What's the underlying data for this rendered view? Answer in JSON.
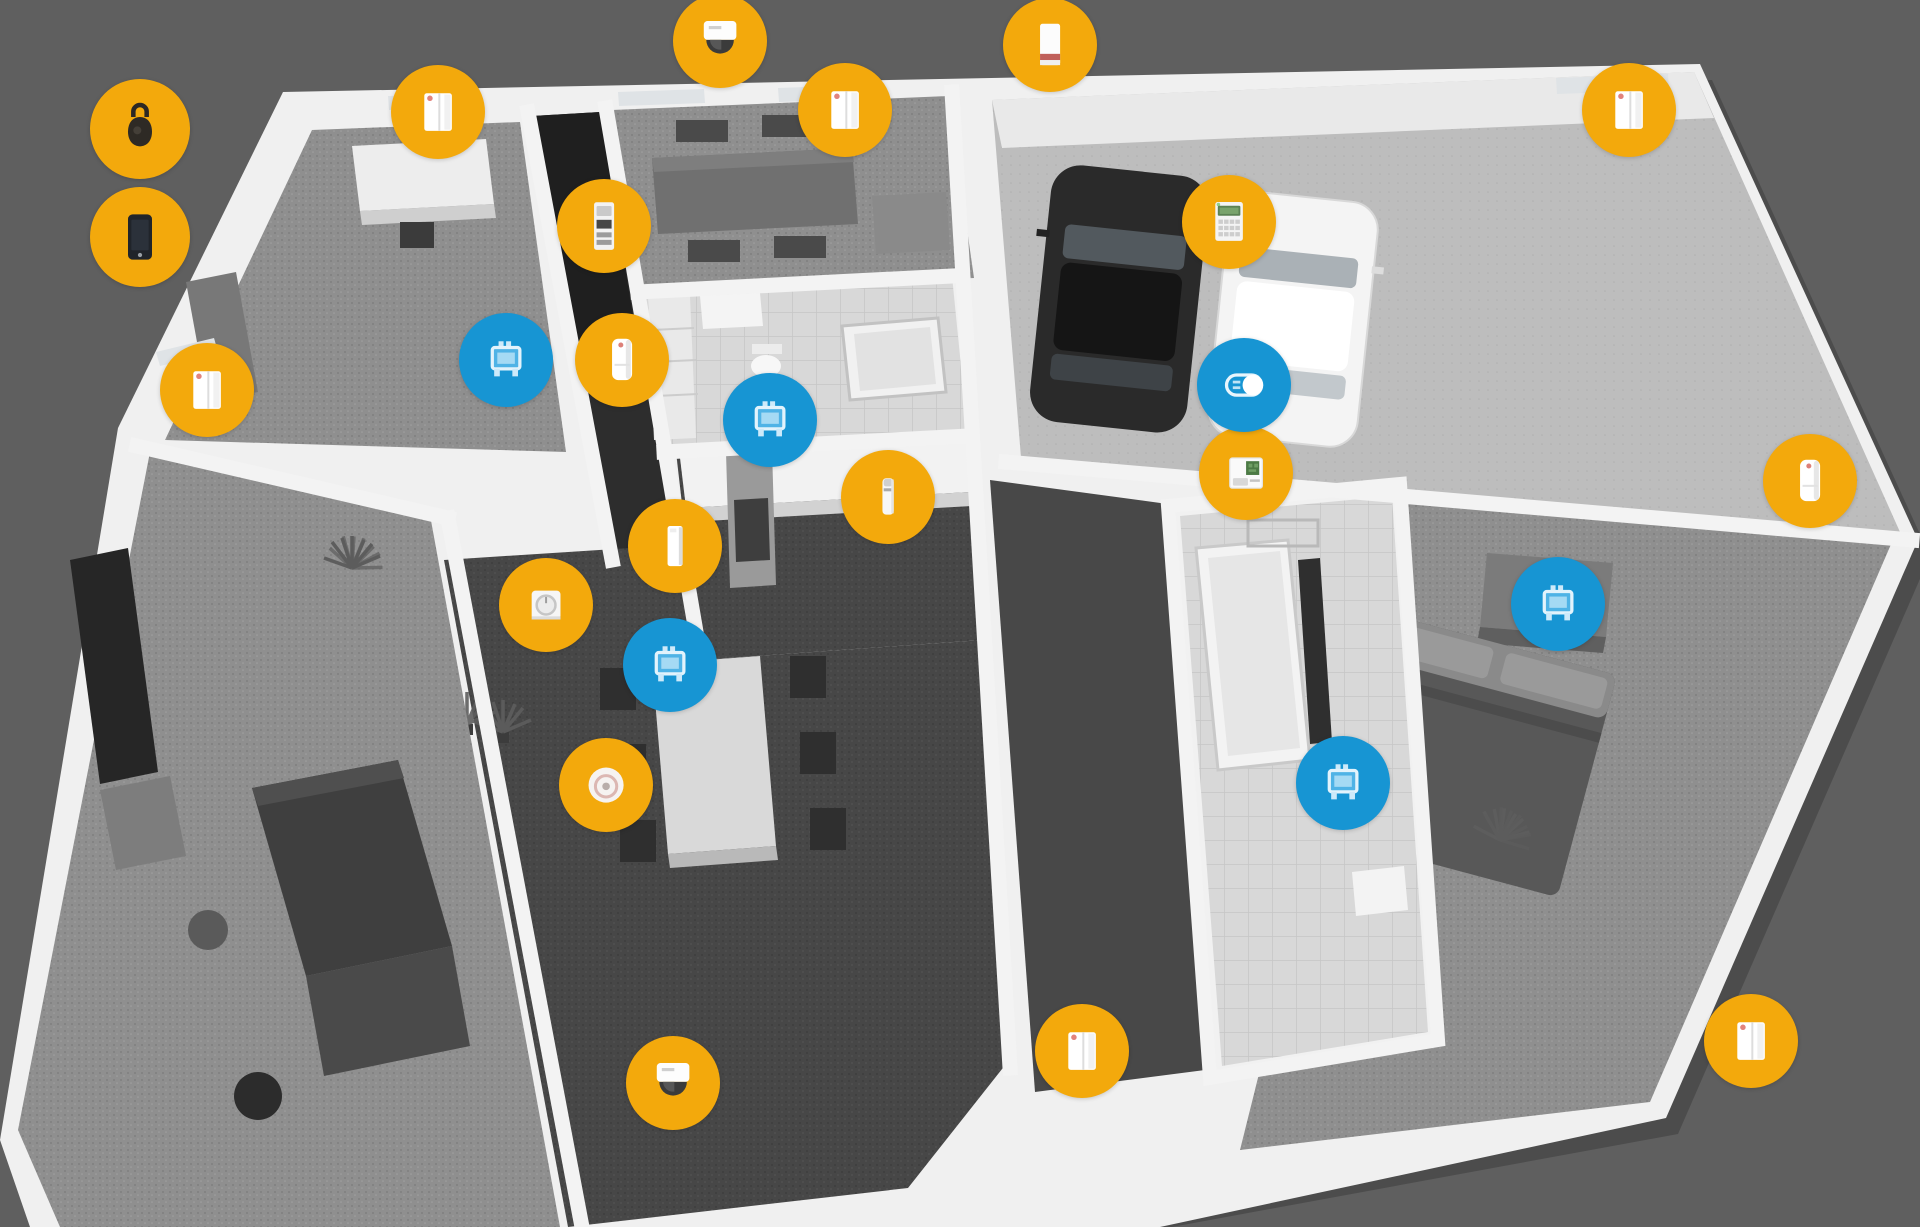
{
  "scene": {
    "description": "3D isometric smart-home floor plan with security and comfort device markers",
    "background_color": "#5f5f5f",
    "width": 1920,
    "height": 1227
  },
  "palette": {
    "marker_yellow": "#F3A90C",
    "marker_blue": "#1795D3",
    "wall_white": "#F0F0F0",
    "accent_red": "#C96057",
    "pcb_green": "#4C7A45",
    "lcd_green": "#5C8254"
  },
  "markers": [
    {
      "icon": "keyfob-icon",
      "type": "keyfob_remote",
      "color": "yellow",
      "x": 140,
      "y": 129,
      "size": 100
    },
    {
      "icon": "smartphone-icon",
      "type": "smartphone",
      "color": "yellow",
      "x": 140,
      "y": 237,
      "size": 100
    },
    {
      "icon": "door-window-sensor-icon",
      "type": "door_window_contact",
      "color": "yellow",
      "x": 438,
      "y": 112
    },
    {
      "icon": "dome-camera-icon",
      "type": "dome_camera",
      "color": "yellow",
      "x": 720,
      "y": 41
    },
    {
      "icon": "door-window-sensor-icon",
      "type": "door_window_contact",
      "color": "yellow",
      "x": 845,
      "y": 110
    },
    {
      "icon": "siren-icon",
      "type": "siren",
      "color": "yellow",
      "x": 1050,
      "y": 45
    },
    {
      "icon": "door-window-sensor-icon",
      "type": "door_window_contact",
      "color": "yellow",
      "x": 1629,
      "y": 110
    },
    {
      "icon": "access-keypad-icon",
      "type": "access_keypad",
      "color": "yellow",
      "x": 604,
      "y": 226
    },
    {
      "icon": "lcd-keypad-icon",
      "type": "lcd_keypad",
      "color": "yellow",
      "x": 1229,
      "y": 222
    },
    {
      "icon": "radiator-valve-icon",
      "type": "radiator_thermostat",
      "color": "blue",
      "x": 506,
      "y": 360
    },
    {
      "icon": "motion-detector-icon",
      "type": "motion_detector",
      "color": "yellow",
      "x": 622,
      "y": 360
    },
    {
      "icon": "door-window-sensor-icon",
      "type": "door_window_contact",
      "color": "yellow",
      "x": 207,
      "y": 390
    },
    {
      "icon": "radiator-valve-icon",
      "type": "radiator_thermostat",
      "color": "blue",
      "x": 770,
      "y": 420
    },
    {
      "icon": "control-panel-icon",
      "type": "control_panel",
      "color": "yellow",
      "x": 1246,
      "y": 473
    },
    {
      "icon": "relay-switch-icon",
      "type": "relay_switch",
      "color": "blue",
      "x": 1244,
      "y": 385
    },
    {
      "icon": "flood-detector-icon",
      "type": "flood_detector",
      "color": "yellow",
      "x": 888,
      "y": 497
    },
    {
      "icon": "door-contact-icon",
      "type": "door_contact_slim",
      "color": "yellow",
      "x": 675,
      "y": 546
    },
    {
      "icon": "motion-detector-icon",
      "type": "motion_detector",
      "color": "yellow",
      "x": 1810,
      "y": 481
    },
    {
      "icon": "wall-thermostat-icon",
      "type": "wall_thermostat",
      "color": "yellow",
      "x": 546,
      "y": 605
    },
    {
      "icon": "radiator-valve-icon",
      "type": "radiator_thermostat",
      "color": "blue",
      "x": 1558,
      "y": 604
    },
    {
      "icon": "radiator-valve-icon",
      "type": "radiator_thermostat",
      "color": "blue",
      "x": 670,
      "y": 665
    },
    {
      "icon": "smoke-detector-icon",
      "type": "smoke_detector",
      "color": "yellow",
      "x": 606,
      "y": 785
    },
    {
      "icon": "radiator-valve-icon",
      "type": "radiator_thermostat",
      "color": "blue",
      "x": 1343,
      "y": 783
    },
    {
      "icon": "door-window-sensor-icon",
      "type": "door_window_contact",
      "color": "yellow",
      "x": 1082,
      "y": 1051
    },
    {
      "icon": "door-window-sensor-icon",
      "type": "door_window_contact",
      "color": "yellow",
      "x": 1751,
      "y": 1041
    },
    {
      "icon": "dome-camera-icon",
      "type": "dome_camera",
      "color": "yellow",
      "x": 673,
      "y": 1083
    }
  ]
}
